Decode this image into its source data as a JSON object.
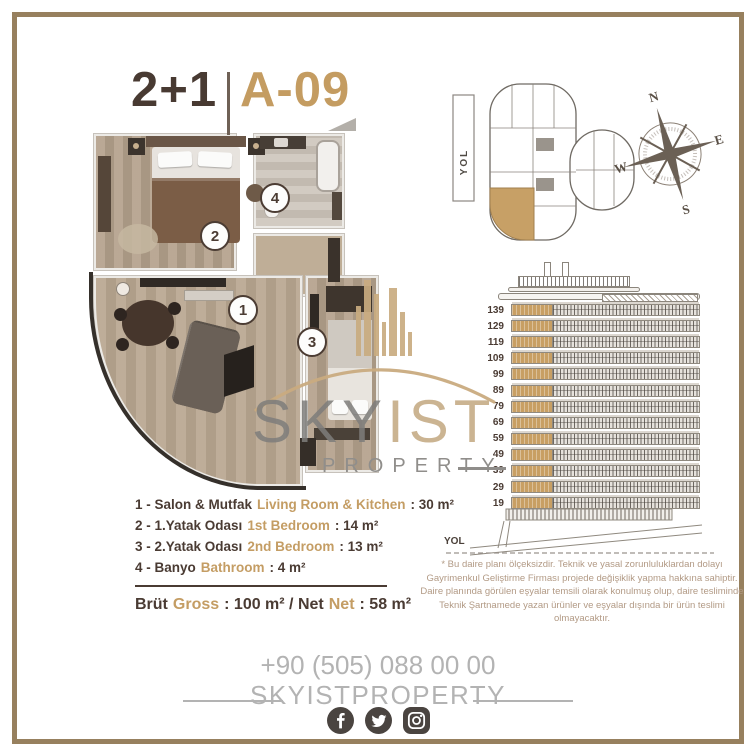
{
  "title": {
    "rooms": "2+1",
    "unit": "A-09"
  },
  "plan": {
    "markers": [
      "1",
      "2",
      "3",
      "4"
    ]
  },
  "key_plan": {
    "road_label": "YOL"
  },
  "compass": {
    "north": "N",
    "east": "E",
    "south": "S",
    "west": "W"
  },
  "elevation": {
    "floors": [
      "139",
      "129",
      "119",
      "109",
      "99",
      "89",
      "79",
      "69",
      "59",
      "49",
      "39",
      "29",
      "19"
    ],
    "road_label": "YOL"
  },
  "legend": {
    "items": [
      {
        "tr": "1 - Salon & Mutfak",
        "en": "Living Room & Kitchen",
        "area": ": 30 m²"
      },
      {
        "tr": "2 - 1.Yatak Odası",
        "en": "1st Bedroom",
        "area": ": 14 m²"
      },
      {
        "tr": "3 - 2.Yatak Odası",
        "en": "2nd Bedroom",
        "area": ": 13 m²"
      },
      {
        "tr": "4 - Banyo",
        "en": "Bathroom",
        "area": ": 4 m²"
      }
    ],
    "totals": {
      "label_tr": "Brüt",
      "label_en": "Gross",
      "mid": ": 100 m² / Net",
      "label_en2": "Net",
      "end": ": 58 m²"
    }
  },
  "disclaimer": {
    "lines": [
      "* Bu daire planı ölçeksizdir. Teknik ve yasal zorunluluklardan dolayı",
      "Gayrimenkul Geliştirme Firması projede değişiklik yapma hakkına sahiptir.",
      "Daire planında görülen eşyalar temsili olarak konulmuş olup, daire tesliminde",
      "Teknik Şartnamede yazan ürünler ve eşyalar dışında bir ürün teslimi olmayacaktır."
    ]
  },
  "watermark": {
    "text_gray": "SKY",
    "text_gold": "IST",
    "subtext": "PROPERTY"
  },
  "footer": {
    "phone": "+90 (505) 088 00 00",
    "brand": "SKYISTPROPERTY",
    "social": [
      "facebook",
      "twitter",
      "instagram"
    ]
  },
  "colors": {
    "accent_gold": "#c49c61",
    "dark_brown": "#4a3b33",
    "frame": "#97805e",
    "muted_gray": "#b3b3b3",
    "disclaimer_text": "#b29a85"
  }
}
